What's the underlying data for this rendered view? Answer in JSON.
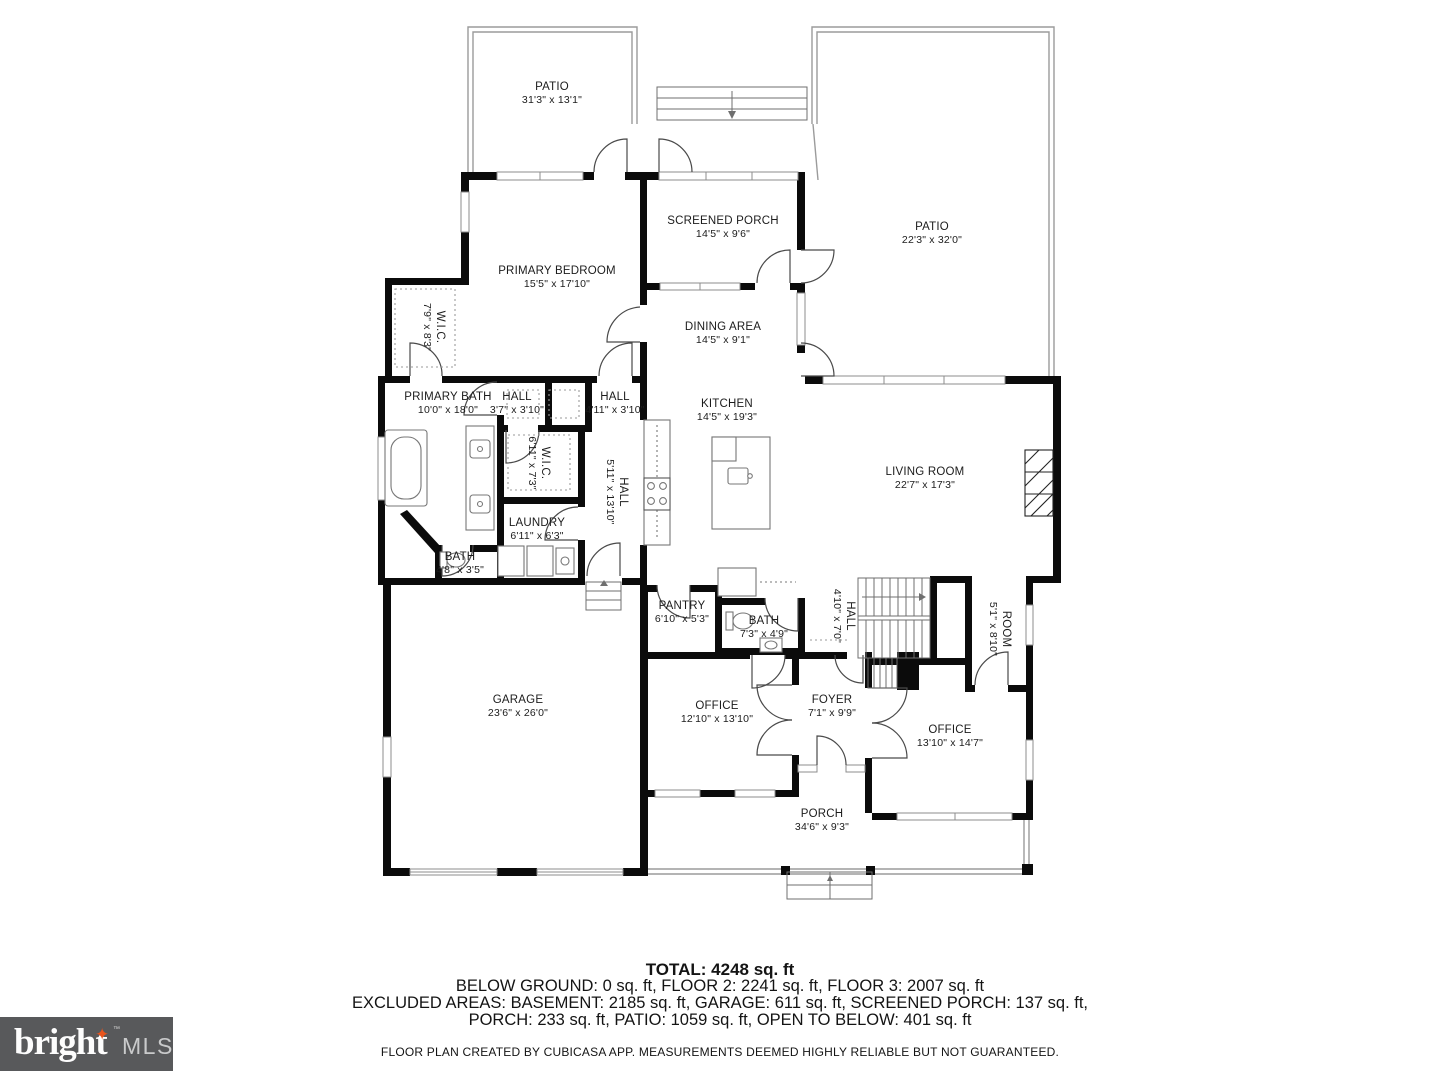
{
  "rooms": [
    {
      "name": "PATIO",
      "dims": "31'3\" x 13'1\""
    },
    {
      "name": "PATIO",
      "dims": "22'3\" x 32'0\""
    },
    {
      "name": "SCREENED PORCH",
      "dims": "14'5\" x 9'6\""
    },
    {
      "name": "PRIMARY BEDROOM",
      "dims": "15'5\" x 17'10\""
    },
    {
      "name": "DINING AREA",
      "dims": "14'5\" x 9'1\""
    },
    {
      "name": "W.I.C.",
      "dims": "7'9\" x 8'3\""
    },
    {
      "name": "PRIMARY BATH",
      "dims": "10'0\" x 18'0\""
    },
    {
      "name": "HALL",
      "dims": "3'7\" x 3'10\""
    },
    {
      "name": "HALL",
      "dims": "4'11\" x 3'10\""
    },
    {
      "name": "W.I.C.",
      "dims": "6'11\" x 7'3\""
    },
    {
      "name": "HALL",
      "dims": "5'11\" x 13'10\""
    },
    {
      "name": "KITCHEN",
      "dims": "14'5\" x 19'3\""
    },
    {
      "name": "LIVING ROOM",
      "dims": "22'7\" x 17'3\""
    },
    {
      "name": "LAUNDRY",
      "dims": "6'11\" x 6'3\""
    },
    {
      "name": "BATH",
      "dims": "4'8\" x 3'5\""
    },
    {
      "name": "PANTRY",
      "dims": "6'10\" x 5'3\""
    },
    {
      "name": "BATH",
      "dims": "7'3\" x 4'9\""
    },
    {
      "name": "HALL",
      "dims": "4'10\" x 7'0\""
    },
    {
      "name": "ROOM",
      "dims": "5'1\" x 8'10\""
    },
    {
      "name": "GARAGE",
      "dims": "23'6\" x 26'0\""
    },
    {
      "name": "OFFICE",
      "dims": "12'10\" x 13'10\""
    },
    {
      "name": "FOYER",
      "dims": "7'1\" x 9'9\""
    },
    {
      "name": "OFFICE",
      "dims": "13'10\" x 14'7\""
    },
    {
      "name": "PORCH",
      "dims": "34'6\" x 9'3\""
    }
  ],
  "summary": {
    "total": "TOTAL: 4248 sq. ft",
    "line2": "BELOW GROUND: 0 sq. ft, FLOOR 2: 2241 sq. ft, FLOOR 3: 2007 sq. ft",
    "line3": "EXCLUDED AREAS: BASEMENT: 2185 sq. ft, GARAGE: 611 sq. ft, SCREENED PORCH: 137 sq. ft,",
    "line4": "PORCH: 233 sq. ft, PATIO: 1059 sq. ft, OPEN TO BELOW: 401 sq. ft",
    "disclaimer": "FLOOR PLAN CREATED BY CUBICASA APP. MEASUREMENTS DEEMED HIGHLY RELIABLE BUT NOT GUARANTEED."
  },
  "logo": {
    "brand": "bright",
    "tm": "™",
    "suffix": "MLS"
  },
  "colors": {
    "wall": "#0b0b0b",
    "background": "#ffffff",
    "logo_bg": "#58595B",
    "logo_star": "#E8541D",
    "logo_mls": "#C9CACB",
    "window_stroke": "#8c8c8c"
  }
}
